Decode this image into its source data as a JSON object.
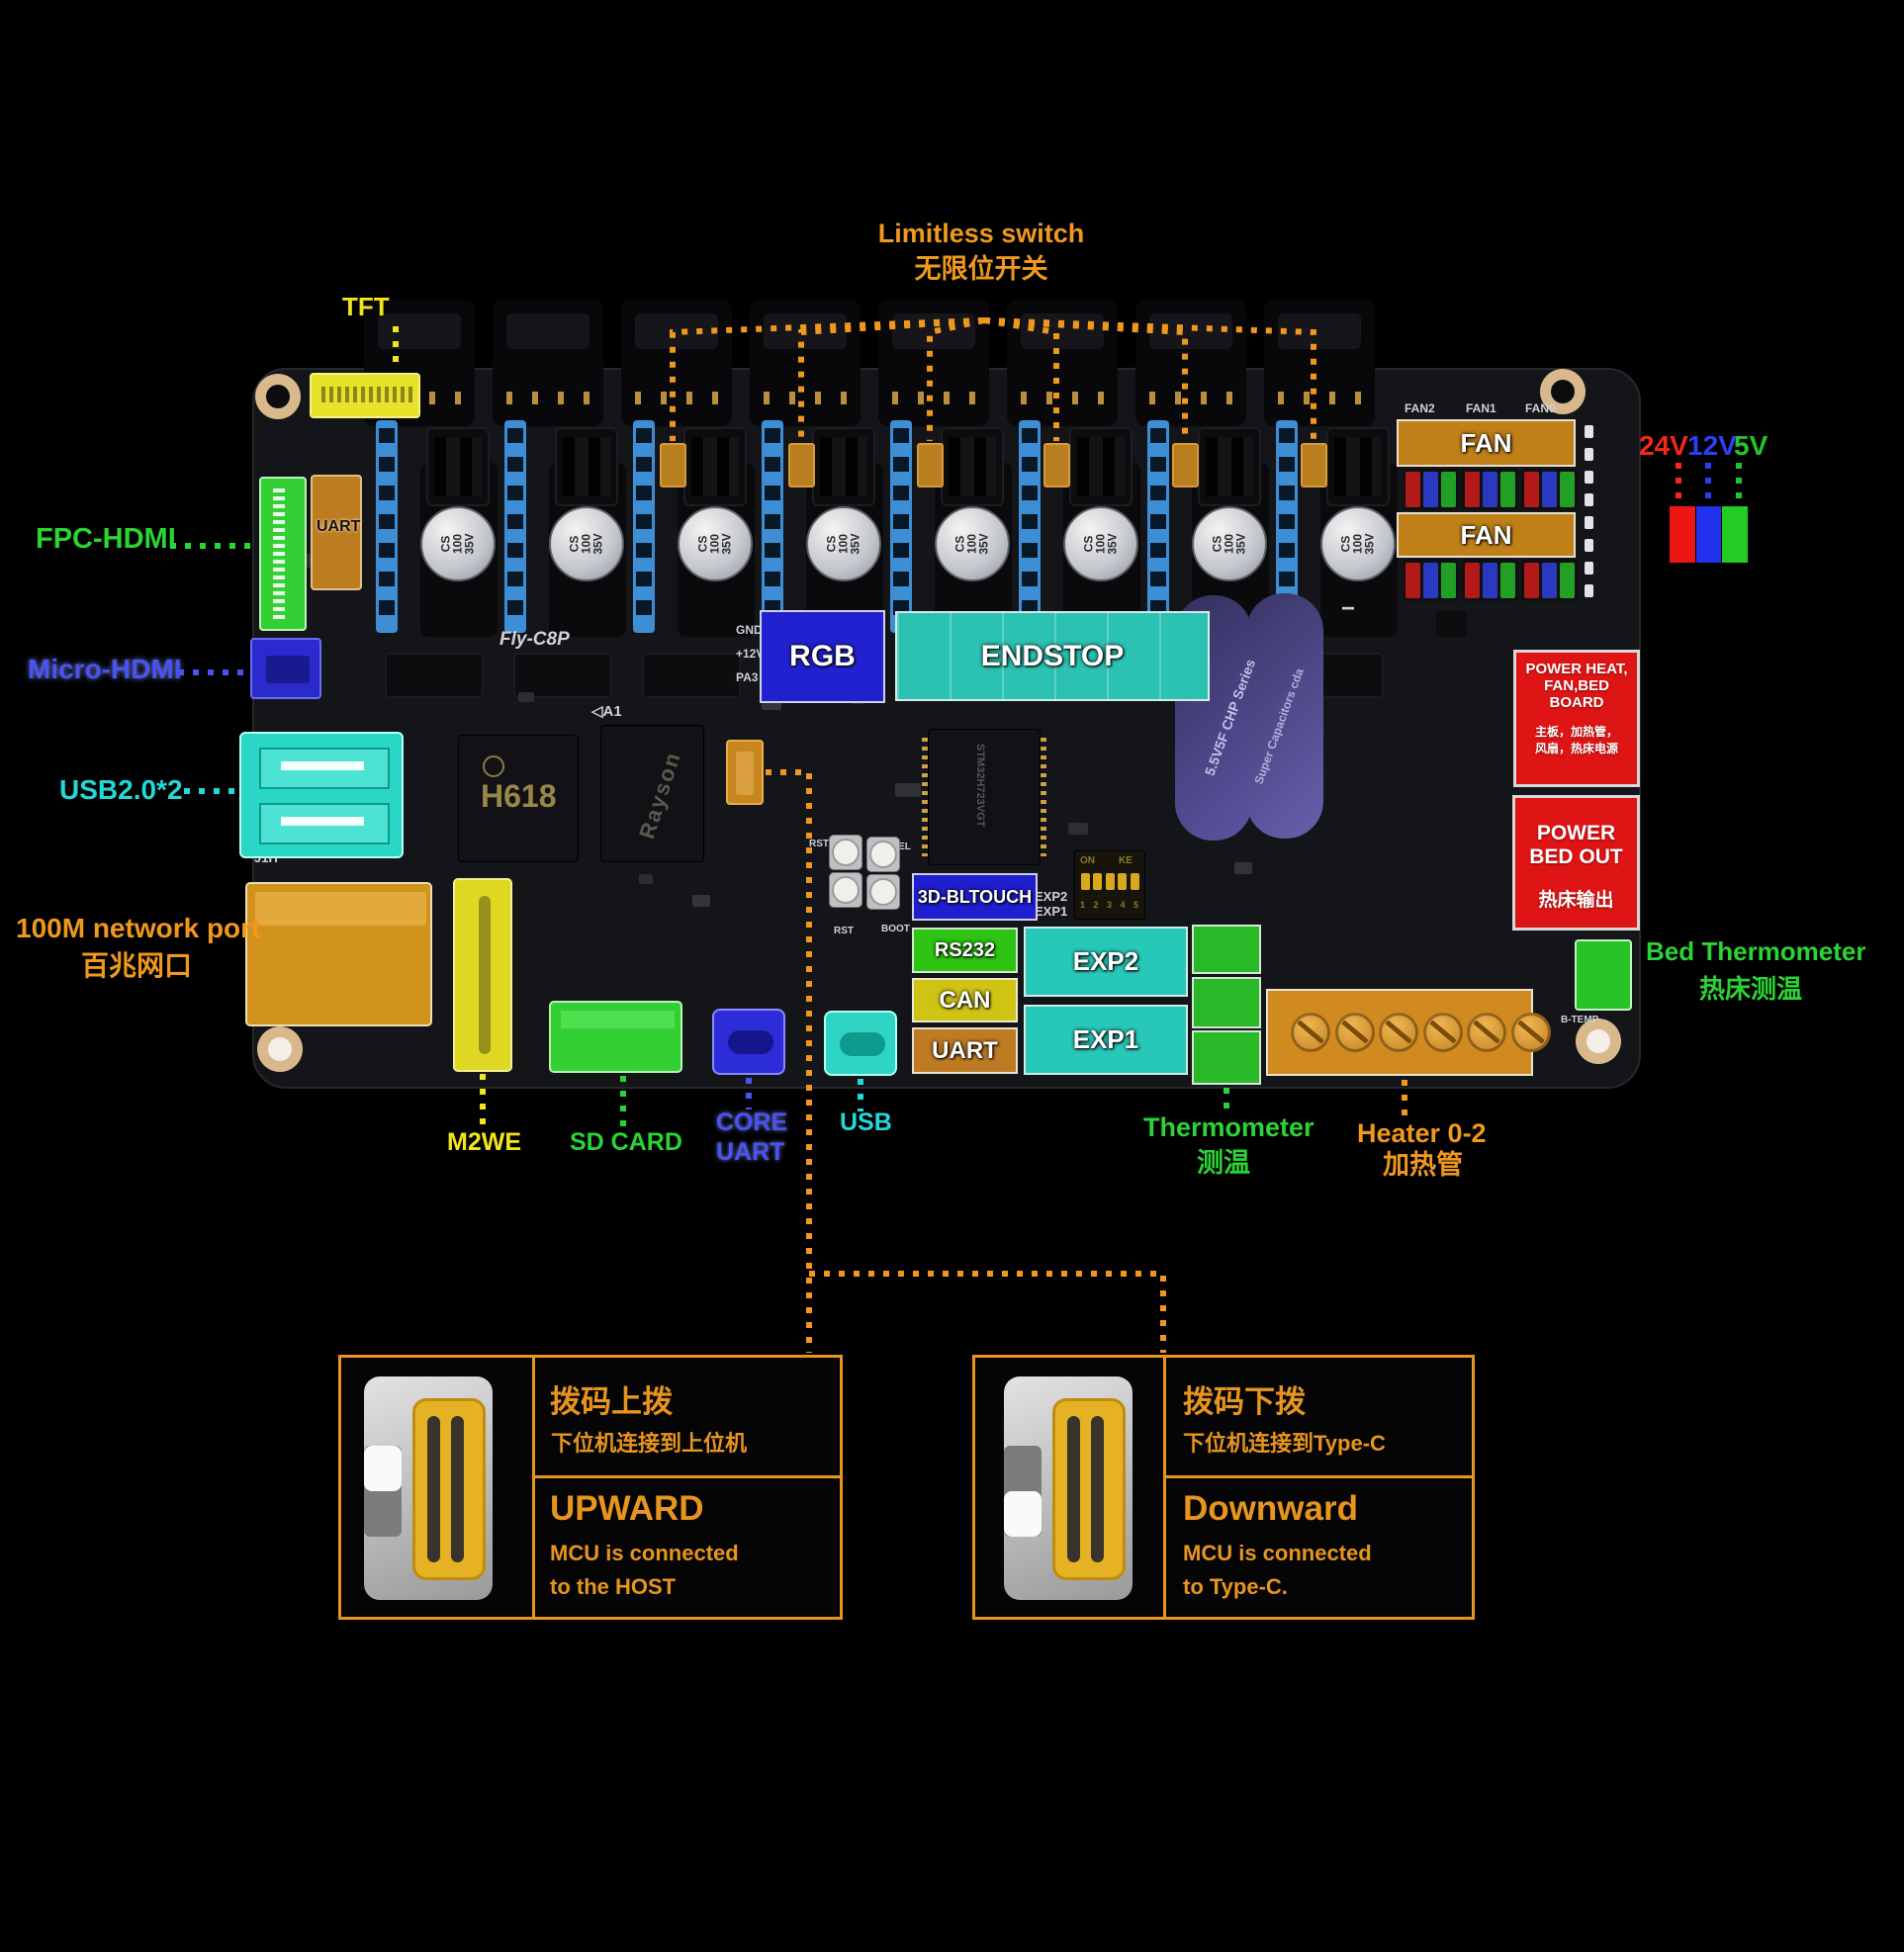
{
  "colors": {
    "orange": "#F0981E",
    "yellow": "#F2E51C",
    "green": "#2BD335",
    "cyan": "#26D7D7",
    "blue": "#4853F2"
  },
  "legend": {
    "items": [
      {
        "label": "24V",
        "color": "#F5261A",
        "swatch": "#EE1515"
      },
      {
        "label": "12V",
        "color": "#2E3EF5",
        "swatch": "#2233EE"
      },
      {
        "label": "5V",
        "color": "#23C32A",
        "swatch": "#22CC22"
      }
    ]
  },
  "annotations": {
    "limitless_en": "Limitless switch",
    "limitless_zh": "无限位开关",
    "tft": "TFT",
    "fpc_hdmi": "FPC-HDMI",
    "micro_hdmi": "Micro-HDMI",
    "usb2": "USB2.0*2",
    "network_en": "100M network port",
    "network_zh": "百兆网口",
    "m2we": "M2WE",
    "sd_card": "SD CARD",
    "core_line1": "CORE",
    "core_line2": "UART",
    "usb": "USB",
    "thermometer_en": "Thermometer",
    "thermometer_zh": "测温",
    "heater_en": "Heater 0-2",
    "heater_zh": "加热管",
    "bed_therm_en": "Bed Thermometer",
    "bed_therm_zh": "热床测温"
  },
  "board_overlays": {
    "uart_top": "UART",
    "rgb": "RGB",
    "endstop": "ENDSTOP",
    "bltouch": "3D-BLTOUCH",
    "rs232": "RS232",
    "can": "CAN",
    "uart_bottom": "UART",
    "exp2": "EXP2",
    "exp1": "EXP1",
    "fan": "FAN"
  },
  "red_boxes": {
    "power_board": {
      "lines": [
        "POWER HEAT,",
        "FAN,BED",
        "BOARD"
      ],
      "zh_lines": [
        "主板，加热管，",
        "风扇，热床电源"
      ]
    },
    "power_bed": {
      "lines": [
        "POWER",
        "BED OUT"
      ],
      "zh": "热床输出"
    }
  },
  "silkscreen": {
    "model": "Fly-C8P",
    "a1": "◁A1",
    "gnd": "GND",
    "v12": "+12V",
    "pa3": "PA3",
    "j1h": "J1H",
    "rst_top": "RST",
    "fel": "FEL",
    "rst": "RST",
    "boot": "BOOT",
    "exp2": "EXP2",
    "exp1": "EXP1",
    "fan2": "FAN2",
    "fan1": "FAN1",
    "fan0": "FAN0",
    "btemp": "B-TEMP",
    "on": "ON",
    "ke": "KE",
    "dip_numbers": "1 2 3 4 5",
    "plus": "+",
    "minus": "−"
  },
  "chips": {
    "soc": "H618",
    "ram": "Rayson",
    "mcu": "STM32H723VGT",
    "cap_label": "CS 100 35V",
    "supercap_line1": "5.5V5F  CHP Series",
    "supercap_line2": "Super Capacitors  cda",
    "jumper_colors": [
      "#B21A1A",
      "#2A3AC0",
      "#22A026"
    ]
  },
  "switch_boxes": {
    "upward": {
      "zh_title": "拨码上拨",
      "zh_sub": "下位机连接到上位机",
      "title": "UPWARD",
      "line1": "MCU is connected",
      "line2": "to the HOST"
    },
    "downward": {
      "zh_title": "拨码下拨",
      "zh_sub": "下位机连接到Type-C",
      "title": "Downward",
      "line1": "MCU is connected",
      "line2": "to Type-C."
    }
  }
}
